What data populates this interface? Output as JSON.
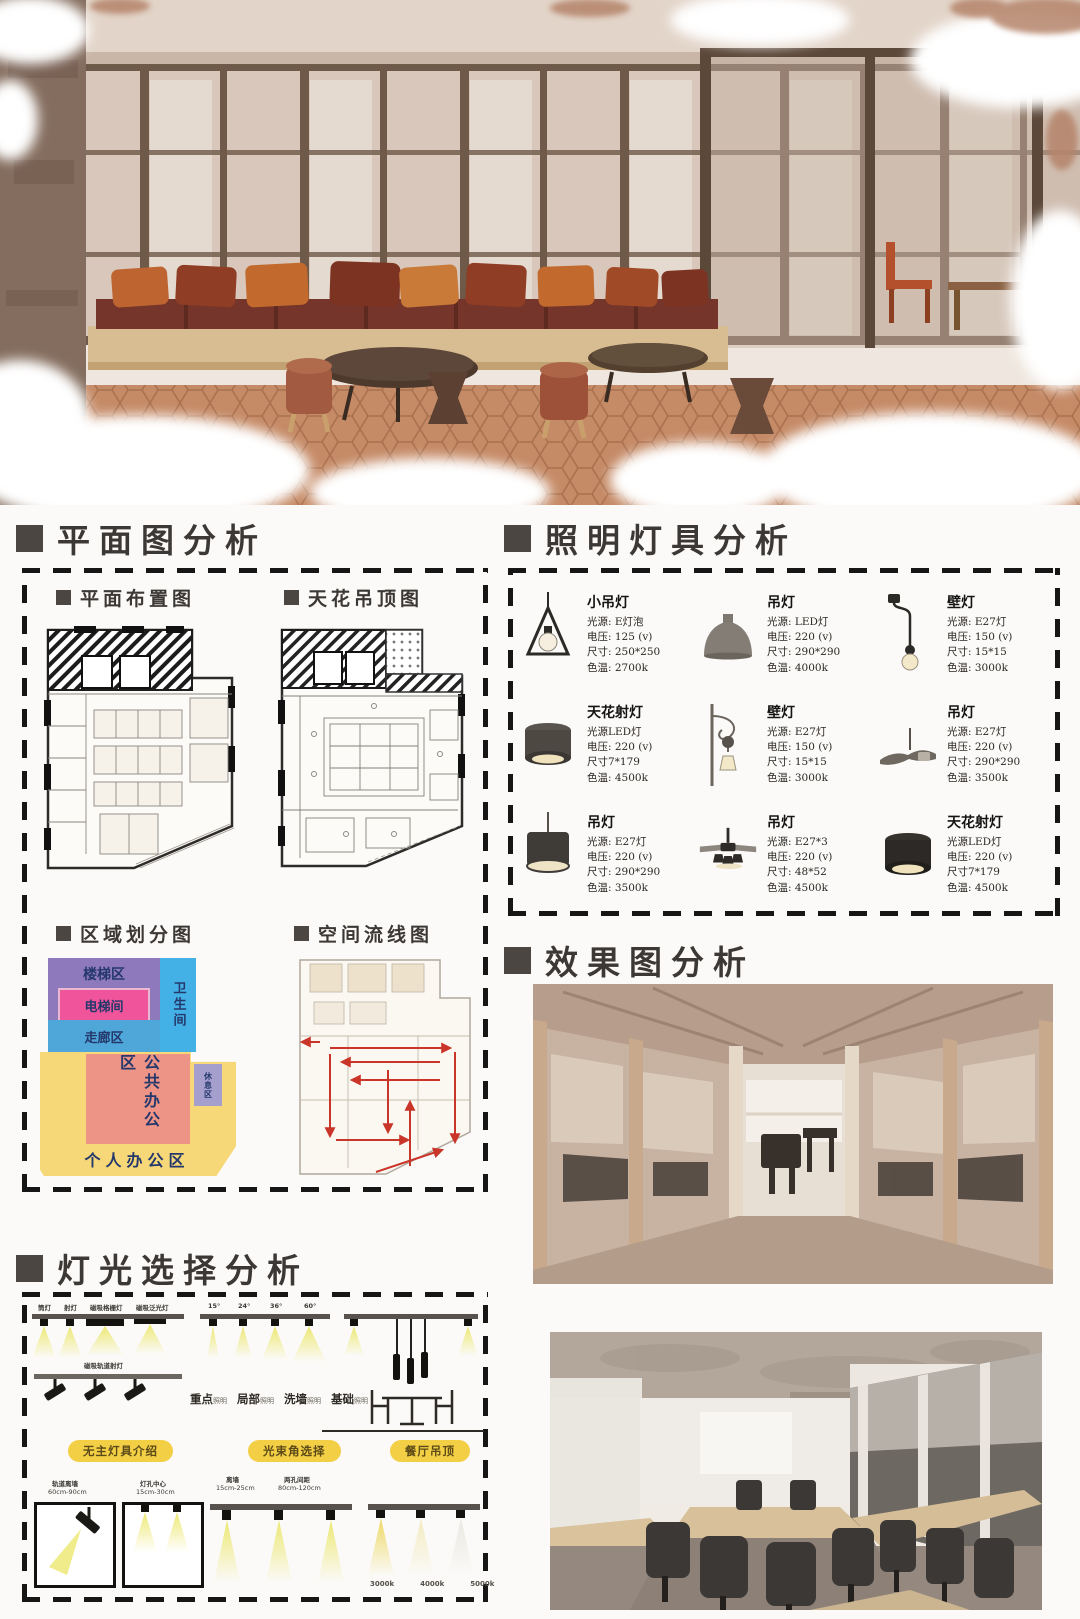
{
  "poster": {
    "headers": {
      "plan": "平面图分析",
      "fixtures": "照明灯具分析",
      "renders": "效果图分析",
      "light_selection": "灯光选择分析"
    }
  },
  "plan_panel": {
    "floor_plan_label": "平面布置图",
    "ceiling_plan_label": "天花吊顶图",
    "zone_map_label": "区域划分图",
    "flow_map_label": "空间流线图",
    "zones": {
      "stairs": "楼梯区",
      "elevator": "电梯间",
      "restroom": "卫生间",
      "corridor": "走廊区",
      "public_office": "公共办公区",
      "personal_office": "个人办公区",
      "rest": "休息区"
    },
    "zone_colors": {
      "stairs": "#8e79bd",
      "elevator": "#f0559c",
      "restroom": "#43b0e6",
      "corridor": "#4fa6d8",
      "public_office": "#ee9486",
      "personal_office": "#f6d878",
      "rest": "#a59fce",
      "label": "#24386b"
    }
  },
  "fixtures": {
    "items": [
      {
        "name": "小吊灯",
        "icon": "triangle-pendant",
        "lines": [
          "光源: E灯泡",
          "电压: 125 (v)",
          "尺寸: 250*250",
          "色温: 2700k"
        ]
      },
      {
        "name": "吊灯",
        "icon": "dome-pendant",
        "lines": [
          "光源: LED灯",
          "电压: 220 (v)",
          "尺寸: 290*290",
          "色温: 4000k"
        ]
      },
      {
        "name": "壁灯",
        "icon": "wall-lamp",
        "lines": [
          "光源: E27灯",
          "电压: 150 (v)",
          "尺寸: 15*15",
          "色温: 3000k"
        ]
      },
      {
        "name": "天花射灯",
        "icon": "ceiling-spotlight",
        "lines": [
          "光源LED灯",
          "电压: 220 (v)",
          "尺寸7*179",
          "色温: 4500k"
        ]
      },
      {
        "name": "壁灯",
        "icon": "ornate-wall-lamp",
        "lines": [
          "光源: E27灯",
          "电压: 150 (v)",
          "尺寸: 15*15",
          "色温: 3000k"
        ]
      },
      {
        "name": "吊灯",
        "icon": "wide-pendant",
        "lines": [
          "光源: E27灯",
          "电压: 220 (v)",
          "尺寸: 290*290",
          "色温: 3500k"
        ]
      },
      {
        "name": "吊灯",
        "icon": "drum-pendant",
        "lines": [
          "光源: E27灯",
          "电压: 220 (v)",
          "尺寸: 290*290",
          "色温: 3500k"
        ]
      },
      {
        "name": "吊灯",
        "icon": "fan-light",
        "lines": [
          "光源: E27*3",
          "电压: 220 (v)",
          "尺寸: 48*52",
          "色温: 4500k"
        ]
      },
      {
        "name": "天花射灯",
        "icon": "ceiling-spotlight",
        "lines": [
          "光源LED灯",
          "电压: 220 (v)",
          "尺寸7*179",
          "色温: 4500k"
        ]
      }
    ]
  },
  "light_selection": {
    "track_types": [
      "筒灯",
      "射灯",
      "磁吸格栅灯",
      "磁吸泛光灯"
    ],
    "beam_angles": [
      "15°",
      "24°",
      "36°",
      "60°"
    ],
    "magnet_track_label": "磁吸轨道射灯",
    "modes": [
      {
        "m": "重点",
        "s": "照明"
      },
      {
        "m": "局部",
        "s": "照明"
      },
      {
        "m": "洗墙",
        "s": "照明"
      },
      {
        "m": "基础",
        "s": "照明"
      }
    ],
    "pills": [
      "无主灯具介绍",
      "光束角选择",
      "餐厅吊顶"
    ],
    "measures": [
      {
        "title": "轨道离墙",
        "value": "60cm-90cm"
      },
      {
        "title": "灯孔中心",
        "value": "15cm-30cm"
      },
      {
        "title": "离墙",
        "value": "15cm-25cm"
      },
      {
        "title": "两孔间距",
        "value": "80cm-120cm"
      }
    ],
    "color_temps": [
      "3000k",
      "4000k",
      "5000k"
    ]
  }
}
